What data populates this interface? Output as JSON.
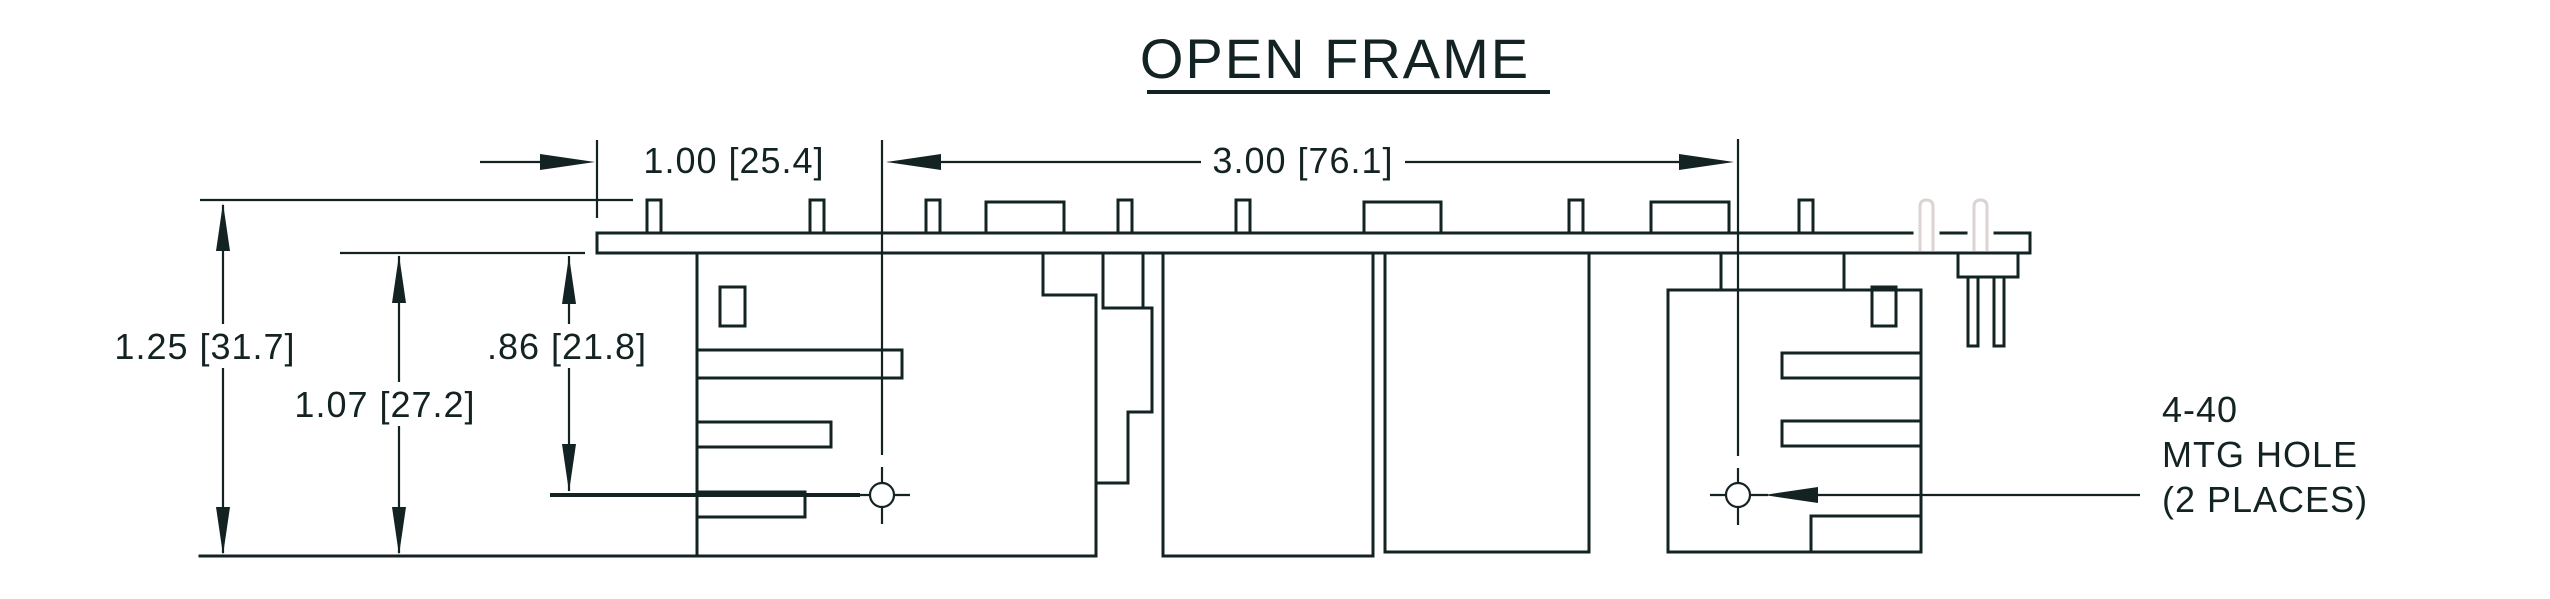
{
  "title": "OPEN FRAME",
  "colors": {
    "ink": "#132222",
    "phantom_line": "#ddd3d3",
    "background": "#ffffff"
  },
  "dimensions": {
    "board_edge_to_hole": "1.00 [25.4]",
    "hole_to_hole": "3.00 [76.1]",
    "overall_height": "1.25 [31.7]",
    "board_to_base": "1.07 [27.2]",
    "board_to_hole": ".86 [21.8]"
  },
  "callout": {
    "line1": "4-40",
    "line2": "MTG HOLE",
    "line3": "(2 PLACES)"
  }
}
